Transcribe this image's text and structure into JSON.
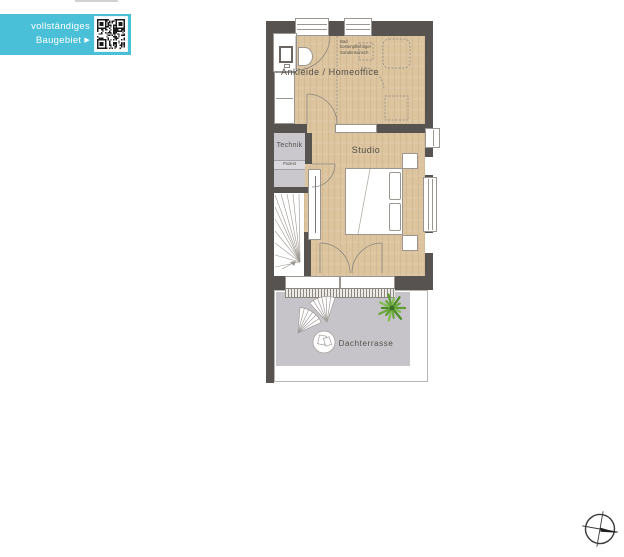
{
  "banner": {
    "line1": "vollständiges",
    "line2": "Baugebiet",
    "arrow": "▶"
  },
  "plan": {
    "rooms": {
      "ankleide": "Ankleide / Homeoffice",
      "technik": "Technik",
      "podest": "Podest",
      "studio": "Studio",
      "terrace": "Dachterrasse"
    },
    "bad_note": [
      "Bad",
      "kostenpflichtiger",
      "Sonderwunsch"
    ]
  },
  "icons": {
    "compass": "north-arrow",
    "qr": "qr-code"
  },
  "colors": {
    "accent": "#49c0d7",
    "wall": "#575350",
    "wood_floor": "#dcc49e",
    "technik_floor": "#cac7cd",
    "terrace_floor": "#c7c4c9",
    "plant_green": "#6da83f"
  }
}
